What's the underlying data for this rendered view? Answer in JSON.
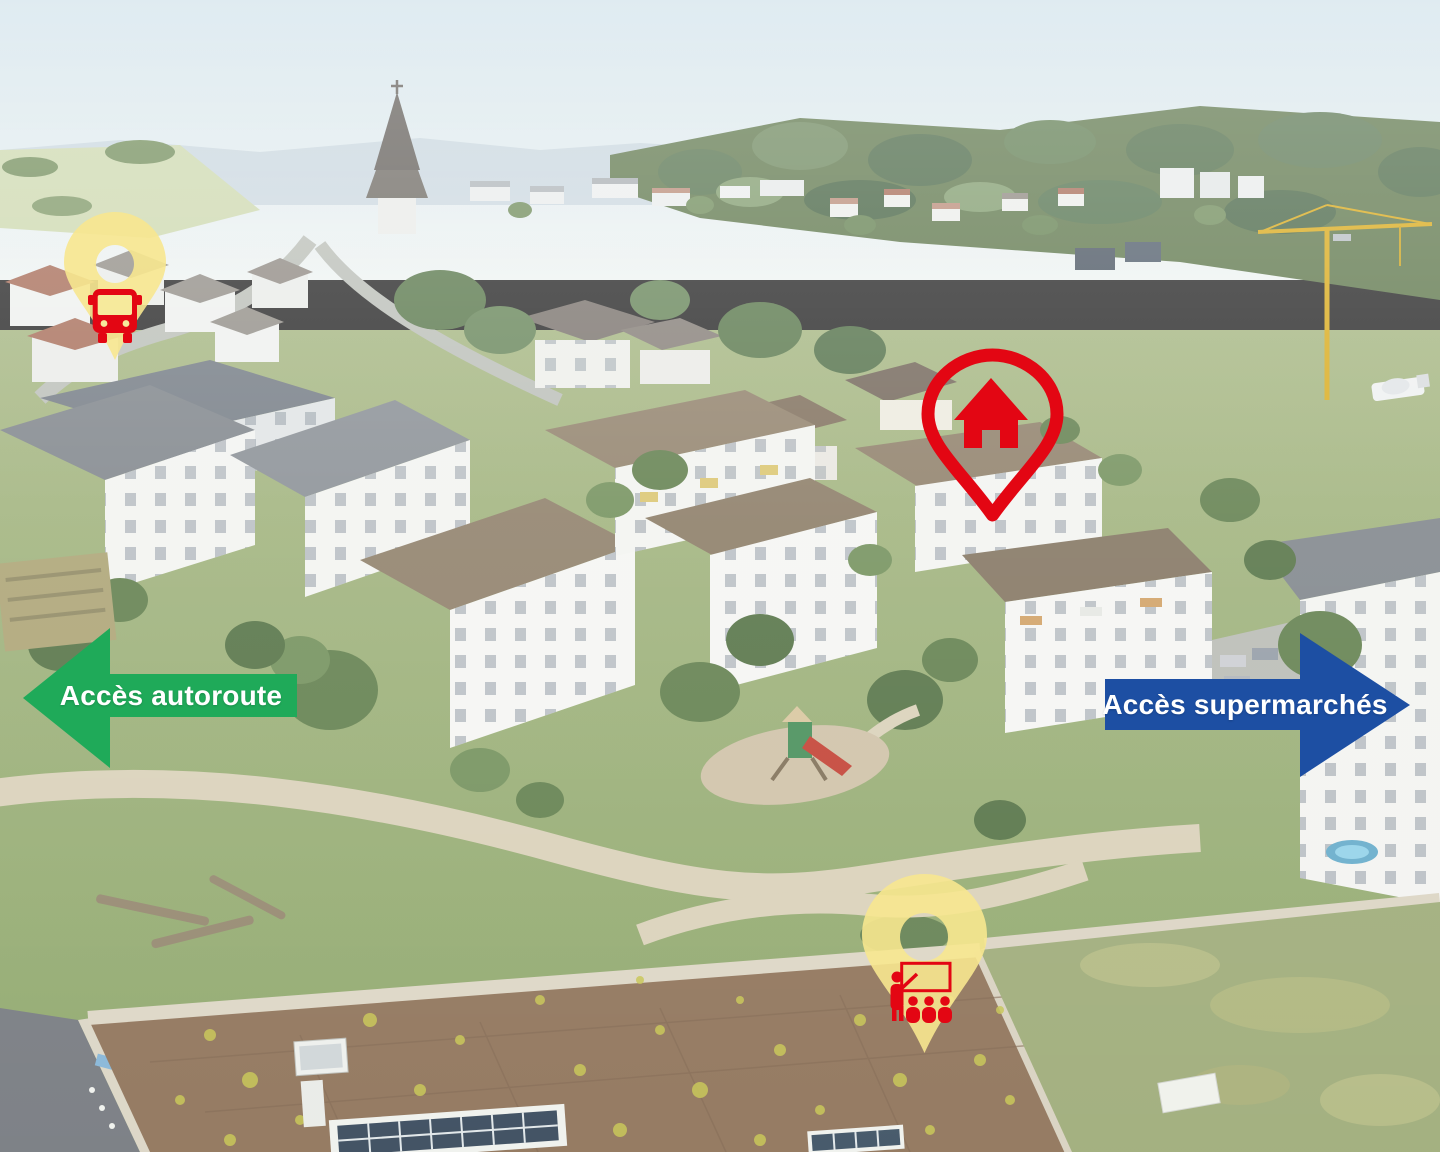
{
  "image_type": "annotated aerial photograph of a residential neighbourhood",
  "annotations": {
    "bus_stop_pin": {
      "icon": "bus-icon",
      "pin_color": "#F7E78F",
      "icon_color": "#E30613"
    },
    "property_pin": {
      "icon": "house-icon",
      "color": "#E30613"
    },
    "school_pin": {
      "icon": "teacher-classroom-icon",
      "pin_color": "#F7E78F",
      "icon_color": "#E30613"
    },
    "highway_arrow": {
      "label": "Accès autoroute",
      "direction": "left",
      "color": "#1FAA59",
      "text_color": "#FFFFFF"
    },
    "supermarket_arrow": {
      "label": "Accès supermarchés",
      "direction": "right",
      "color": "#1D4FA3",
      "text_color": "#FFFFFF"
    }
  },
  "scene": {
    "landmarks": [
      "church-spire",
      "village-houses",
      "apartment-buildings",
      "lawns-and-paths",
      "playground",
      "construction-crane",
      "flat-green-roof-school",
      "solar-panels"
    ]
  }
}
